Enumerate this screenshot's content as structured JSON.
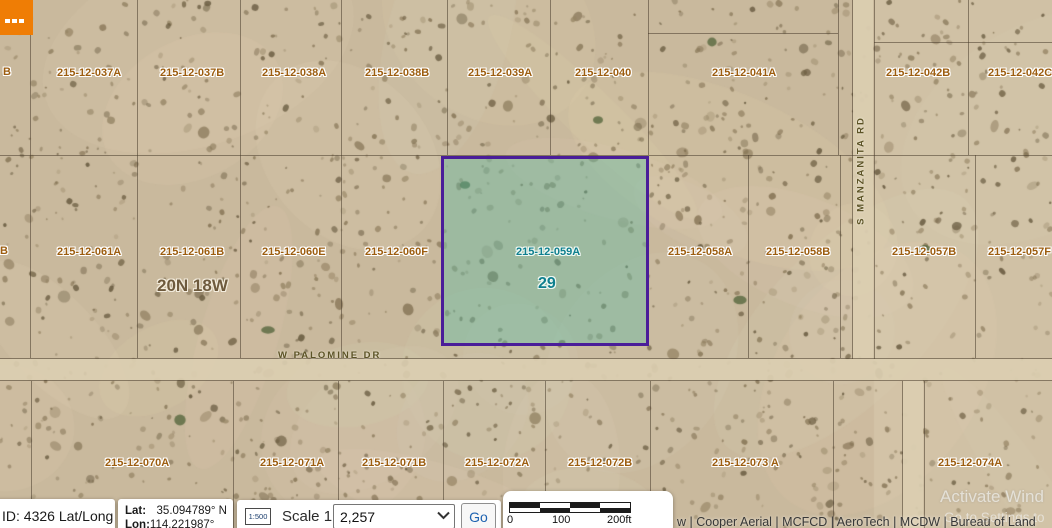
{
  "toolbar": {
    "menu_button_icon": "ellipsis"
  },
  "map": {
    "township_label": "20N 18W",
    "selected_parcel": {
      "apn": "215-12-059A",
      "lot": "29"
    },
    "roads": {
      "palomine": "W PALOMINE DR",
      "manzanita": "S MANZANITA RD"
    },
    "labels_top": [
      "B",
      "215-12-037A",
      "215-12-037B",
      "215-12-038A",
      "215-12-038B",
      "215-12-039A",
      "215-12-040",
      "215-12-041A",
      "215-12-042B",
      "215-12-042C"
    ],
    "labels_mid": [
      "B",
      "215-12-061A",
      "215-12-061B",
      "215-12-060E",
      "215-12-060F",
      "215-12-058A",
      "215-12-058B",
      "215-12-057B",
      "215-12-057F"
    ],
    "labels_bottom": [
      "215-12-070A",
      "215-12-071A",
      "215-12-071B",
      "215-12-072A",
      "215-12-072B",
      "215-12-073 A",
      "215-12-074A"
    ]
  },
  "statusbar": {
    "srid": {
      "text": "ID: 4326 Lat/Long",
      "expander": "▲"
    },
    "coords": {
      "lat_label": "Lat:",
      "lat_value": "35.094789° N",
      "lon_label": "Lon:",
      "lon_value": "114.221987° W"
    },
    "scale": {
      "icon_text": "1:500",
      "label": "Scale 1:",
      "value": "2,257",
      "go": "Go"
    },
    "scalebar": {
      "ticks": [
        "0",
        "100",
        "200ft"
      ]
    },
    "attribution": "w | Cooper Aerial | MCFCD | AeroTech | MCDW | Bureau of Land",
    "watermark": {
      "line1": "Activate Wind",
      "line2": "Go to Settings to"
    }
  }
}
